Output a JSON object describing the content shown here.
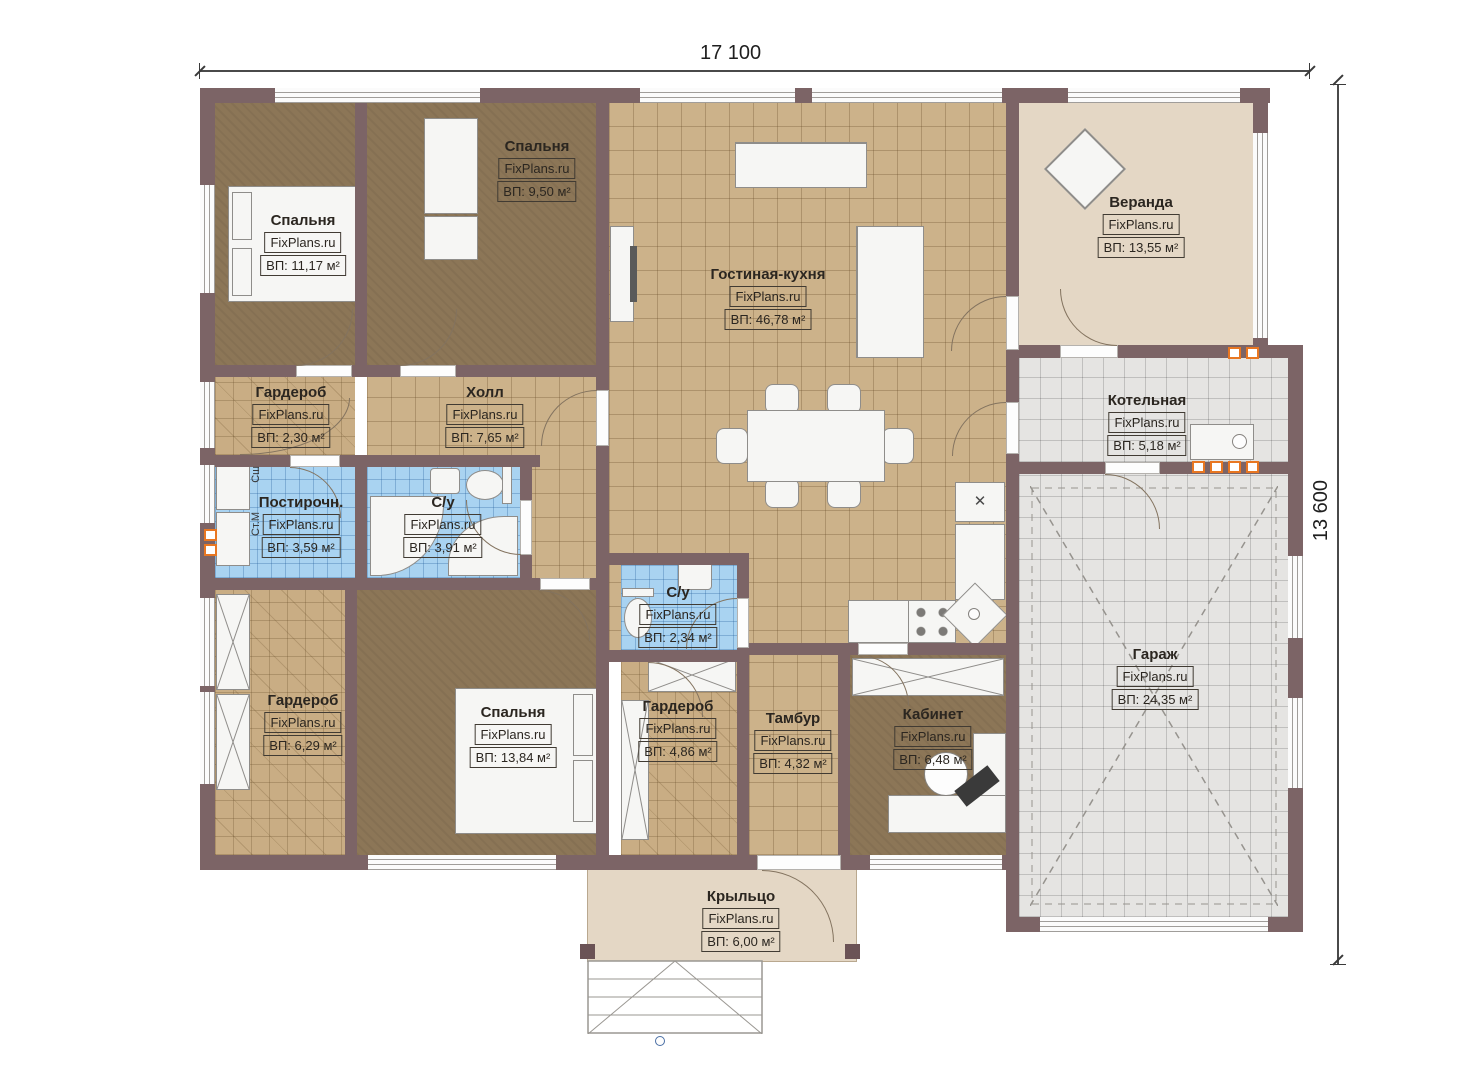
{
  "meta": {
    "brand": "FixPlans.ru",
    "plan_type": "single-storey house floor plan"
  },
  "dims": {
    "width": "17 100",
    "height": "13 600"
  },
  "rooms": [
    {
      "name": "Спальня",
      "brand": "FixPlans.ru",
      "area": "ВП: 11,17 м²"
    },
    {
      "name": "Спальня",
      "brand": "FixPlans.ru",
      "area": "ВП: 9,50 м²"
    },
    {
      "name": "Гостиная-кухня",
      "brand": "FixPlans.ru",
      "area": "ВП: 46,78 м²"
    },
    {
      "name": "Веранда",
      "brand": "FixPlans.ru",
      "area": "ВП: 13,55 м²"
    },
    {
      "name": "Гардероб",
      "brand": "FixPlans.ru",
      "area": "ВП: 2,30 м²"
    },
    {
      "name": "Холл",
      "brand": "FixPlans.ru",
      "area": "ВП: 7,65 м²"
    },
    {
      "name": "Котельная",
      "brand": "FixPlans.ru",
      "area": "ВП: 5,18 м²"
    },
    {
      "name": "Постирочн.",
      "brand": "FixPlans.ru",
      "area": "ВП: 3,59 м²"
    },
    {
      "name": "С/у",
      "brand": "FixPlans.ru",
      "area": "ВП: 3,91 м²"
    },
    {
      "name": "С/у",
      "brand": "FixPlans.ru",
      "area": "ВП: 2,34 м²"
    },
    {
      "name": "Гардероб",
      "brand": "FixPlans.ru",
      "area": "ВП: 6,29 м²"
    },
    {
      "name": "Спальня",
      "brand": "FixPlans.ru",
      "area": "ВП: 13,84 м²"
    },
    {
      "name": "Гардероб",
      "brand": "FixPlans.ru",
      "area": "ВП: 4,86 м²"
    },
    {
      "name": "Тамбур",
      "brand": "FixPlans.ru",
      "area": "ВП: 4,32 м²"
    },
    {
      "name": "Кабинет",
      "brand": "FixPlans.ru",
      "area": "ВП: 6,48 м²"
    },
    {
      "name": "Гараж",
      "brand": "FixPlans.ru",
      "area": "ВП: 24,35 м²"
    },
    {
      "name": "Крыльцо",
      "brand": "FixPlans.ru",
      "area": "ВП: 6,00 м²"
    }
  ],
  "appliances": {
    "dryer": "Сш",
    "washer": "Ст.М"
  },
  "symbols": {
    "fridge_cross": "✕"
  },
  "colors": {
    "wall": "#7c6466",
    "tile_tan": "#ccb28a",
    "floor_brown": "#8c7657",
    "floor_beige": "#e4d7c5",
    "tile_gray": "#e5e4e2",
    "tile_blue": "#a9d3f1",
    "accent_orange": "#e87722"
  }
}
